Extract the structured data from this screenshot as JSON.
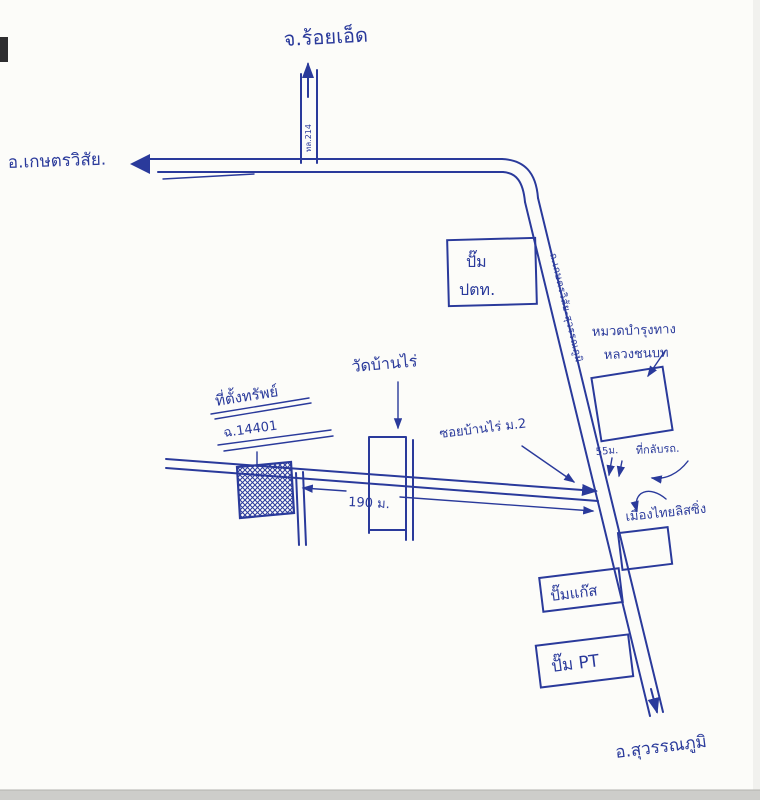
{
  "meta": {
    "ink": "#2a3a9b",
    "paper": "#fcfcf9",
    "type": "hand-drawn location sketch map"
  },
  "destinations": {
    "north": "จ.ร้อยเอ็ด",
    "west": "อ.เกษตรวิสัย.",
    "south": "อ.สุวรรณภูมิ"
  },
  "roads": {
    "north_highway": "ทล.214",
    "main_highway": "ถ.เกษตรวิสัย-สุวรรณภูมิ",
    "soi": "ซอยบ้านไร่ ม.2"
  },
  "landmarks": {
    "ptt_station_line1": "ปั๊ม",
    "ptt_station_line2": "ปตท.",
    "maintenance_line1": "หมวดบำรุงทาง",
    "maintenance_line2": "หลวงชนบท",
    "temple": "วัดบ้านไร่",
    "leasing": "เมืองไทยลิสซิ่ง",
    "gas_station": "ปั๊มแก๊ส",
    "pt_station": "ปั๊ม PT",
    "u_turn": "ที่กลับรถ."
  },
  "property": {
    "title": "ที่ตั้งทรัพย์",
    "deed_no": "ฉ.14401"
  },
  "distances": {
    "soi_to_highway": "190 ม.",
    "junction_to_uturn": "55ม."
  }
}
